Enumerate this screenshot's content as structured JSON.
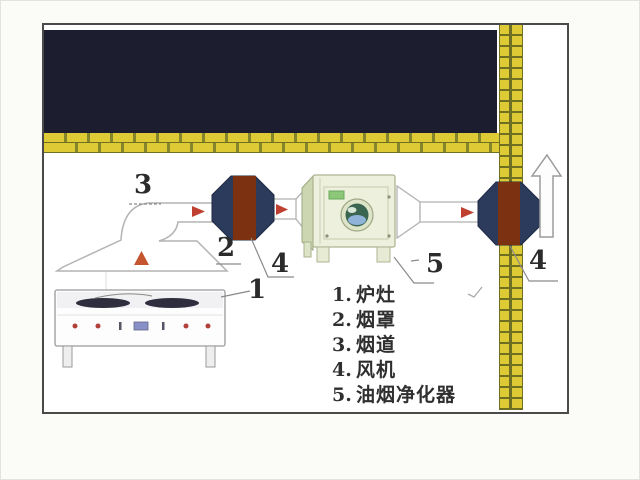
{
  "callouts": {
    "stove_num": "1",
    "hood_num": "2",
    "flue_num": "3",
    "fan_num": "4",
    "purifier_num": "5"
  },
  "legend": {
    "items": [
      {
        "num": "1.",
        "label": "炉灶"
      },
      {
        "num": "2.",
        "label": "烟罩"
      },
      {
        "num": "3.",
        "label": "烟道"
      },
      {
        "num": "4.",
        "label": "风机"
      },
      {
        "num": "5.",
        "label": "油烟净化器"
      }
    ]
  },
  "colors": {
    "ceiling": "#1d1d30",
    "brick": "#ddca34",
    "brick_mortar": "#6f6f24",
    "fan_housing": "#2c3a5c",
    "fan_core": "#7c3110",
    "flow_arrow": "#bf4030",
    "purifier_body": "#edf0dd",
    "frame_border": "#4a4a4a"
  }
}
